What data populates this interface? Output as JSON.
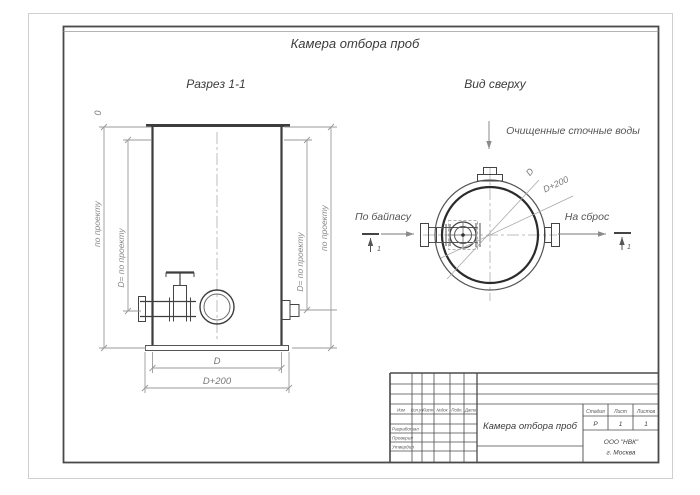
{
  "colors": {
    "ink": "#3d3d3d",
    "dimension": "#9a9a9a",
    "centerline": "#bdbdbd",
    "text": "#4a4a4a"
  },
  "sheet": {
    "title": "Камера отбора проб"
  },
  "section_view": {
    "title": "Разрез 1-1",
    "elevation_zero": "0",
    "dim_depth": "по проекту",
    "dim_diameter_depth": "D= по проекту",
    "dim_width": "D",
    "dim_base_width": "D+200"
  },
  "plan_view": {
    "title": "Вид сверху",
    "inflow_label": "Очищенные сточные воды",
    "bypass_label": "По байпасу",
    "discharge_label": "На сброс",
    "dim_diameter": "D",
    "dim_outer_diameter": "D+200",
    "section_mark": "1"
  },
  "title_block": {
    "doc_title": "Камера отбора проб",
    "rev_columns": [
      "Изм",
      "Кол.уч",
      "Лист",
      "№док",
      "Подп.",
      "Дата"
    ],
    "roles": [
      "Разработал",
      "Проверил",
      "Утвердил"
    ],
    "stage_header": [
      "Стадия",
      "Лист",
      "Листов"
    ],
    "stage_values": [
      "Р",
      "1",
      "1"
    ],
    "company_line1": "ООО \"НВК\"",
    "company_line2": "г. Москва"
  }
}
